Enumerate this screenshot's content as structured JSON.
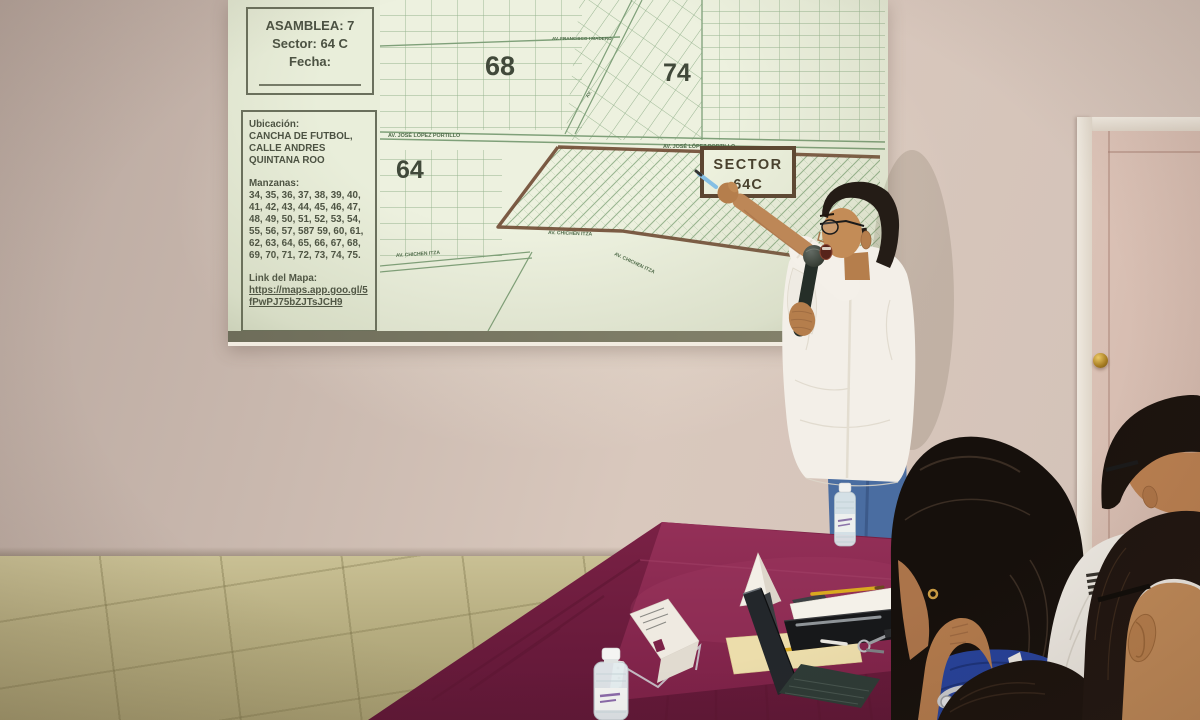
{
  "slide": {
    "header": {
      "assembly": "ASAMBLEA: 7",
      "sector": "Sector: 64 C",
      "date_label": "Fecha:"
    },
    "info": {
      "location_label": "Ubicación:",
      "location_value": "CANCHA DE FUTBOL,\nCALLE ANDRES\nQUINTANA ROO",
      "blocks_label": "Manzanas:",
      "blocks_value": "34, 35, 36, 37, 38, 39, 40, 41, 42, 43, 44, 45, 46, 47, 48, 49, 50, 51, 52, 53, 54, 55, 56, 57, 587 59, 60, 61, 62, 63, 64, 65, 66, 67, 68, 69, 70, 71, 72, 73, 74, 75.",
      "map_link_label": "Link del Mapa:",
      "map_link_value": "https://maps.app.goo.gl/5fPwPJ75bZJTsJCH9"
    },
    "map": {
      "district_68": "68",
      "district_74": "74",
      "district_64": "64",
      "sector_box_line1": "SECTOR",
      "sector_box_line2": "64C",
      "street_madero": "AV. FRANCISCO I MADERO",
      "street_portillo": "AV. JOSÉ LÓPEZ PORTILLO",
      "street_chichen": "AV. CHICHEN ITZA",
      "street_diagonal_abbrev": "AV."
    }
  },
  "colors": {
    "slide_background": "#e9eeda",
    "map_line_green": "#8aab84",
    "sector_outline_brown": "#6f4a33",
    "tablecloth_burgundy": "#8c2950",
    "wall_beige": "#cdbcb2",
    "door_pink": "#d8bfb3",
    "floor_khaki": "#b6ad80",
    "presenter_shirt": "#f3efe8",
    "presenter_jeans": "#4a6da1",
    "audience_blue_top": "#26429a"
  }
}
